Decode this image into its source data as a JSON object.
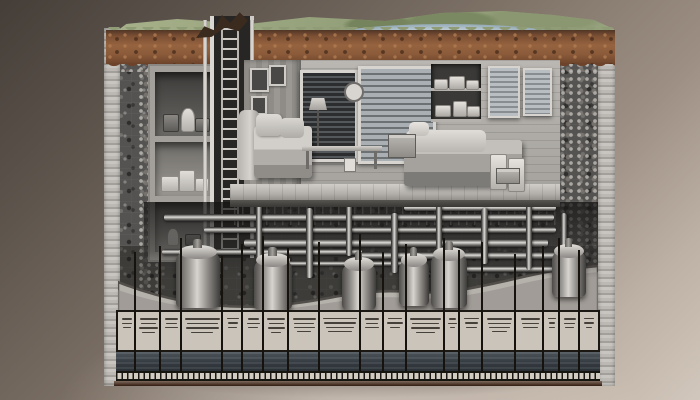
{
  "meta": {
    "description": "Photorealistic cutaway illustration of an underground bunker: grass and lake terrain on top, brown soil layer, gray aggregate earth block, furnished living quarters with storage rooms and access ladder shaft, a dense utility pipe network below the floor, boiler tanks in an excavated trench, and an annotation legend table with illegible micro-text along the bottom edge"
  },
  "palette": {
    "backdrop_dark": "#453e38",
    "backdrop_light": "#d2c7bc",
    "grass": "#98a47e",
    "lake": "#aabdc7",
    "soil": "#8a5a3a",
    "aggregate": "#555351",
    "cut_face": "#bcb9b4",
    "room_wall": "#b0ada8",
    "metal_pipe": "#dedcd8",
    "table_bg": "#cac4ba",
    "table_ink": "#45403a",
    "dark_band": "#343b41",
    "bottom_edge": "#4b3326"
  },
  "scene": {
    "interior": {
      "storage_rooms": [
        {
          "top": 6,
          "height": 64,
          "tone": "dark",
          "items": [
            {
              "l": 8,
              "b": 4,
              "w": 14,
              "h": 16,
              "kind": "dark"
            },
            {
              "l": 26,
              "b": 4,
              "w": 12,
              "h": 22,
              "kind": "jug"
            },
            {
              "l": 40,
              "b": 4,
              "w": 13,
              "h": 12,
              "kind": "dark"
            }
          ]
        },
        {
          "top": 76,
          "height": 54,
          "tone": "mid",
          "items": [
            {
              "l": 6,
              "b": 4,
              "w": 16,
              "h": 14,
              "kind": "light"
            },
            {
              "l": 24,
              "b": 4,
              "w": 14,
              "h": 20,
              "kind": "light"
            },
            {
              "l": 40,
              "b": 4,
              "w": 12,
              "h": 12,
              "kind": "light"
            }
          ]
        },
        {
          "top": 136,
          "height": 50,
          "tone": "mid",
          "items": [
            {
              "l": 12,
              "b": 6,
              "w": 10,
              "h": 16,
              "kind": "jug"
            },
            {
              "l": 30,
              "b": 6,
              "w": 14,
              "h": 10,
              "kind": "dark"
            }
          ]
        }
      ],
      "windows": [
        {
          "left": 56,
          "top": 10,
          "width": 52,
          "height": 86,
          "style": "dark"
        },
        {
          "left": 114,
          "top": 6,
          "width": 72,
          "height": 92,
          "style": "blinds"
        },
        {
          "left": 244,
          "top": 6,
          "width": 28,
          "height": 48,
          "style": "framed"
        },
        {
          "left": 279,
          "top": 8,
          "width": 25,
          "height": 44,
          "style": "framed"
        }
      ],
      "frames": [
        {
          "left": 6,
          "top": 8,
          "width": 15,
          "height": 20
        },
        {
          "left": 25,
          "top": 5,
          "width": 13,
          "height": 17
        },
        {
          "left": 7,
          "top": 36,
          "width": 12,
          "height": 15
        }
      ],
      "shelf_stacks": [
        {
          "l": 3,
          "b": 32,
          "w": 12,
          "h": 9
        },
        {
          "l": 18,
          "b": 32,
          "w": 14,
          "h": 12
        },
        {
          "l": 35,
          "b": 32,
          "w": 11,
          "h": 8
        },
        {
          "l": 4,
          "b": 5,
          "w": 14,
          "h": 10
        },
        {
          "l": 22,
          "b": 5,
          "w": 12,
          "h": 14
        },
        {
          "l": 36,
          "b": 5,
          "w": 11,
          "h": 9
        }
      ]
    },
    "utilities": {
      "pipes": [
        {
          "dir": "h",
          "x": 60,
          "y": 206,
          "w": 390,
          "h": 7
        },
        {
          "dir": "h",
          "x": 100,
          "y": 219,
          "w": 352,
          "h": 6
        },
        {
          "dir": "h",
          "x": 140,
          "y": 231,
          "w": 304,
          "h": 8
        },
        {
          "dir": "h",
          "x": 58,
          "y": 241,
          "w": 200,
          "h": 6
        },
        {
          "dir": "h",
          "x": 252,
          "y": 244,
          "w": 200,
          "h": 7
        },
        {
          "dir": "h",
          "x": 300,
          "y": 197,
          "w": 152,
          "h": 6
        },
        {
          "dir": "h",
          "x": 180,
          "y": 253,
          "w": 122,
          "h": 5
        },
        {
          "dir": "h",
          "x": 352,
          "y": 258,
          "w": 108,
          "h": 6
        },
        {
          "dir": "v",
          "x": 152,
          "y": 196,
          "w": 6,
          "h": 60
        },
        {
          "dir": "v",
          "x": 202,
          "y": 200,
          "w": 7,
          "h": 70
        },
        {
          "dir": "v",
          "x": 242,
          "y": 196,
          "w": 6,
          "h": 52
        },
        {
          "dir": "v",
          "x": 287,
          "y": 205,
          "w": 7,
          "h": 60
        },
        {
          "dir": "v",
          "x": 332,
          "y": 196,
          "w": 6,
          "h": 70
        },
        {
          "dir": "v",
          "x": 377,
          "y": 200,
          "w": 7,
          "h": 56
        },
        {
          "dir": "v",
          "x": 422,
          "y": 196,
          "w": 6,
          "h": 66
        },
        {
          "dir": "v",
          "x": 457,
          "y": 205,
          "w": 6,
          "h": 52
        }
      ],
      "tanks": [
        {
          "x": 72,
          "y": 244,
          "w": 44,
          "h": 56
        },
        {
          "x": 150,
          "y": 252,
          "w": 38,
          "h": 50
        },
        {
          "x": 238,
          "y": 256,
          "w": 34,
          "h": 46
        },
        {
          "x": 295,
          "y": 252,
          "w": 30,
          "h": 46
        },
        {
          "x": 327,
          "y": 246,
          "w": 36,
          "h": 54
        },
        {
          "x": 448,
          "y": 243,
          "w": 34,
          "h": 46
        }
      ]
    },
    "legend": {
      "columns": [
        {
          "w": 0.7,
          "lead_top": 256,
          "lines": [
            [
              55,
              2
            ],
            [
              60,
              1
            ],
            [
              40,
              1
            ]
          ]
        },
        {
          "w": 1.0,
          "lead_top": 244,
          "lines": [
            [
              70,
              2
            ],
            [
              60,
              1
            ],
            [
              75,
              2
            ],
            [
              50,
              1
            ]
          ]
        },
        {
          "w": 0.8,
          "lead_top": 238,
          "lines": [
            [
              60,
              2
            ],
            [
              55,
              1
            ],
            [
              65,
              1
            ]
          ]
        },
        {
          "w": 1.6,
          "lead_top": 230,
          "lines": [
            [
              85,
              2
            ],
            [
              75,
              1
            ],
            [
              80,
              2
            ],
            [
              55,
              1
            ]
          ]
        },
        {
          "w": 0.8,
          "lead_top": 248,
          "lines": [
            [
              60,
              1
            ],
            [
              50,
              2
            ],
            [
              45,
              1
            ]
          ]
        },
        {
          "w": 0.8,
          "lead_top": 236,
          "lines": [
            [
              55,
              2
            ],
            [
              65,
              1
            ],
            [
              50,
              1
            ]
          ]
        },
        {
          "w": 1.0,
          "lead_top": 228,
          "lines": [
            [
              70,
              2
            ],
            [
              60,
              1
            ],
            [
              65,
              2
            ],
            [
              40,
              1
            ]
          ]
        },
        {
          "w": 1.2,
          "lead_top": 240,
          "lines": [
            [
              75,
              2
            ],
            [
              65,
              1
            ],
            [
              70,
              1
            ],
            [
              45,
              1
            ]
          ]
        },
        {
          "w": 1.6,
          "lead_top": 234,
          "lines": [
            [
              85,
              1
            ],
            [
              80,
              2
            ],
            [
              70,
              1
            ],
            [
              60,
              1
            ]
          ]
        },
        {
          "w": 0.9,
          "lead_top": 226,
          "lines": [
            [
              65,
              2
            ],
            [
              55,
              1
            ],
            [
              60,
              1
            ]
          ]
        },
        {
          "w": 0.9,
          "lead_top": 244,
          "lines": [
            [
              60,
              1
            ],
            [
              70,
              2
            ],
            [
              45,
              1
            ]
          ]
        },
        {
          "w": 1.5,
          "lead_top": 236,
          "lines": [
            [
              80,
              2
            ],
            [
              70,
              1
            ],
            [
              75,
              2
            ],
            [
              50,
              1
            ]
          ]
        },
        {
          "w": 0.6,
          "lead_top": 230,
          "lines": [
            [
              50,
              2
            ],
            [
              55,
              1
            ],
            [
              35,
              1
            ]
          ]
        },
        {
          "w": 0.9,
          "lead_top": 242,
          "lines": [
            [
              65,
              1
            ],
            [
              60,
              2
            ],
            [
              50,
              1
            ]
          ]
        },
        {
          "w": 1.3,
          "lead_top": 234,
          "lines": [
            [
              75,
              2
            ],
            [
              70,
              1
            ],
            [
              65,
              1
            ],
            [
              45,
              1
            ]
          ]
        },
        {
          "w": 1.1,
          "lead_top": 246,
          "lines": [
            [
              70,
              2
            ],
            [
              60,
              1
            ],
            [
              55,
              1
            ]
          ]
        },
        {
          "w": 0.6,
          "lead_top": 238,
          "lines": [
            [
              50,
              1
            ],
            [
              45,
              2
            ],
            [
              40,
              1
            ]
          ]
        },
        {
          "w": 0.8,
          "lead_top": 230,
          "lines": [
            [
              60,
              2
            ],
            [
              55,
              1
            ],
            [
              45,
              1
            ]
          ]
        },
        {
          "w": 0.7,
          "lead_top": 242,
          "lines": [
            [
              55,
              1
            ],
            [
              60,
              2
            ],
            [
              35,
              1
            ]
          ]
        }
      ]
    }
  }
}
